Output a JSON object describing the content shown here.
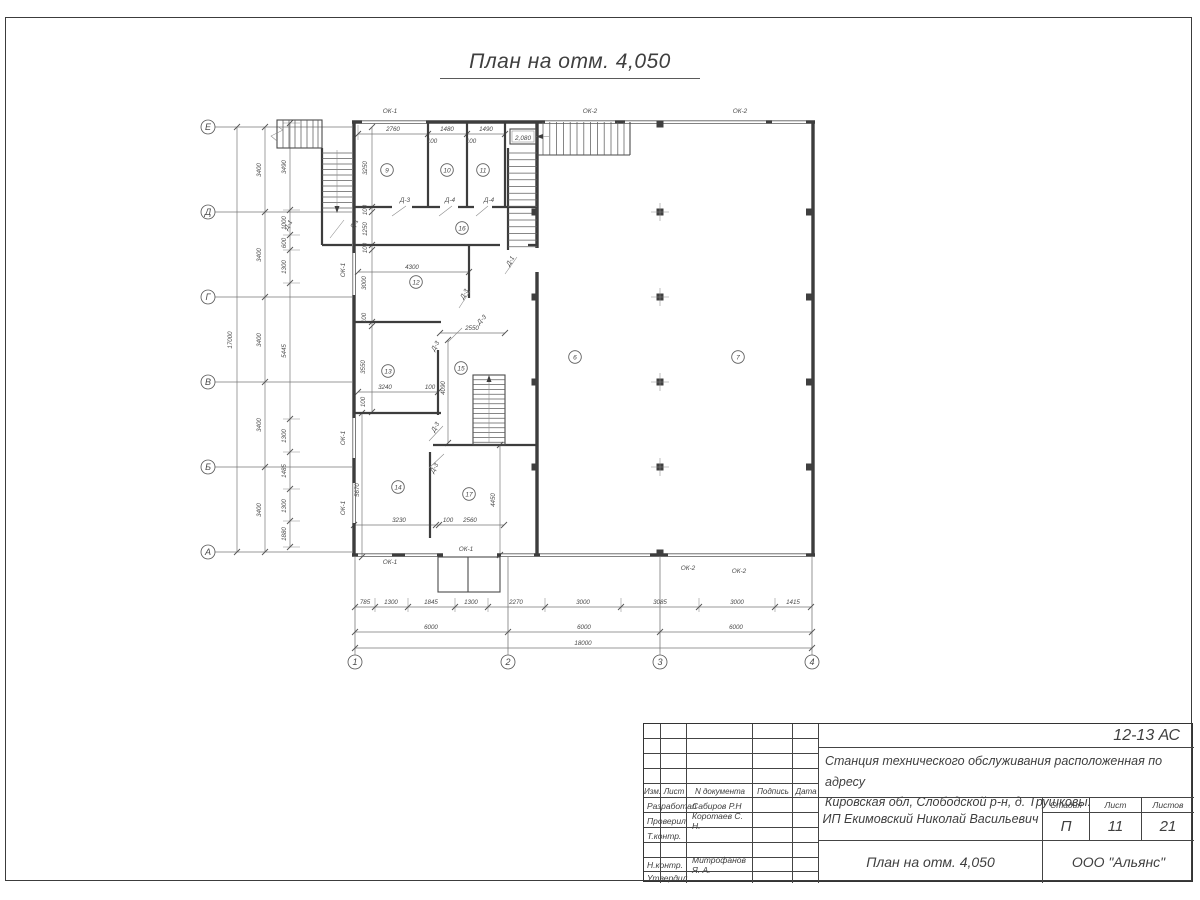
{
  "drawing_title": "План на отм. 4,050",
  "plan": {
    "axis_rows": [
      {
        "label": "Е",
        "y": 127
      },
      {
        "label": "Д",
        "y": 212
      },
      {
        "label": "Г",
        "y": 297
      },
      {
        "label": "В",
        "y": 382
      },
      {
        "label": "Б",
        "y": 467
      },
      {
        "label": "А",
        "y": 552
      }
    ],
    "axis_cols": [
      {
        "label": "1",
        "x": 355
      },
      {
        "label": "2",
        "x": 508
      },
      {
        "label": "3",
        "x": 660
      },
      {
        "label": "4",
        "x": 812
      }
    ],
    "rooms": [
      {
        "t": "9",
        "x": 387,
        "y": 170
      },
      {
        "t": "10",
        "x": 447,
        "y": 170
      },
      {
        "t": "11",
        "x": 483,
        "y": 170
      },
      {
        "t": "16",
        "x": 462,
        "y": 228
      },
      {
        "t": "12",
        "x": 416,
        "y": 282
      },
      {
        "t": "13",
        "x": 388,
        "y": 371
      },
      {
        "t": "15",
        "x": 461,
        "y": 368
      },
      {
        "t": "14",
        "x": 398,
        "y": 487
      },
      {
        "t": "17",
        "x": 469,
        "y": 494
      },
      {
        "t": "6",
        "x": 575,
        "y": 357
      },
      {
        "t": "7",
        "x": 738,
        "y": 357
      }
    ],
    "dims": [
      {
        "t": "17000",
        "x": 232,
        "y": 340,
        "r": -90
      },
      {
        "t": "3400",
        "x": 261,
        "y": 170,
        "r": -90
      },
      {
        "t": "3400",
        "x": 261,
        "y": 255,
        "r": -90
      },
      {
        "t": "3400",
        "x": 261,
        "y": 340,
        "r": -90
      },
      {
        "t": "3400",
        "x": 261,
        "y": 425,
        "r": -90
      },
      {
        "t": "3400",
        "x": 261,
        "y": 510,
        "r": -90
      },
      {
        "t": "3490",
        "x": 286,
        "y": 167,
        "r": -90
      },
      {
        "t": "1000",
        "x": 286,
        "y": 223,
        "r": -90
      },
      {
        "t": "600",
        "x": 286,
        "y": 243,
        "r": -90
      },
      {
        "t": "1300",
        "x": 286,
        "y": 267,
        "r": -90
      },
      {
        "t": "5445",
        "x": 286,
        "y": 351,
        "r": -90
      },
      {
        "t": "1300",
        "x": 286,
        "y": 436,
        "r": -90
      },
      {
        "t": "1485",
        "x": 286,
        "y": 471,
        "r": -90
      },
      {
        "t": "1300",
        "x": 286,
        "y": 506,
        "r": -90
      },
      {
        "t": "1880",
        "x": 286,
        "y": 534,
        "r": -90
      },
      {
        "t": "785",
        "x": 365,
        "y": 604
      },
      {
        "t": "1300",
        "x": 391,
        "y": 604
      },
      {
        "t": "1845",
        "x": 431,
        "y": 604
      },
      {
        "t": "1300",
        "x": 471,
        "y": 604
      },
      {
        "t": "2270",
        "x": 516,
        "y": 604
      },
      {
        "t": "3000",
        "x": 583,
        "y": 604
      },
      {
        "t": "3085",
        "x": 660,
        "y": 604
      },
      {
        "t": "3000",
        "x": 737,
        "y": 604
      },
      {
        "t": "1415",
        "x": 793,
        "y": 604
      },
      {
        "t": "6000",
        "x": 431,
        "y": 629
      },
      {
        "t": "6000",
        "x": 584,
        "y": 629
      },
      {
        "t": "6000",
        "x": 736,
        "y": 629
      },
      {
        "t": "18000",
        "x": 583,
        "y": 645
      },
      {
        "t": "2760",
        "x": 393,
        "y": 131
      },
      {
        "t": "1480",
        "x": 447,
        "y": 131
      },
      {
        "t": "1490",
        "x": 486,
        "y": 131
      },
      {
        "t": "100",
        "x": 432,
        "y": 143
      },
      {
        "t": "100",
        "x": 471,
        "y": 143
      },
      {
        "t": "3250",
        "x": 367,
        "y": 168,
        "r": -90
      },
      {
        "t": "100",
        "x": 367,
        "y": 210,
        "r": -90
      },
      {
        "t": "1250",
        "x": 367,
        "y": 229,
        "r": -90
      },
      {
        "t": "100",
        "x": 367,
        "y": 248,
        "r": -90
      },
      {
        "t": "3000",
        "x": 366,
        "y": 283,
        "r": -90
      },
      {
        "t": "100",
        "x": 366,
        "y": 318,
        "r": -90
      },
      {
        "t": "3550",
        "x": 365,
        "y": 367,
        "r": -90
      },
      {
        "t": "100",
        "x": 365,
        "y": 402,
        "r": -90
      },
      {
        "t": "5670",
        "x": 359,
        "y": 490,
        "r": -90
      },
      {
        "t": "4300",
        "x": 412,
        "y": 269
      },
      {
        "t": "2550",
        "x": 472,
        "y": 330
      },
      {
        "t": "3240",
        "x": 385,
        "y": 389
      },
      {
        "t": "100",
        "x": 430,
        "y": 389
      },
      {
        "t": "4090",
        "x": 445,
        "y": 388,
        "r": -90
      },
      {
        "t": "3230",
        "x": 399,
        "y": 522
      },
      {
        "t": "100",
        "x": 448,
        "y": 522
      },
      {
        "t": "2560",
        "x": 470,
        "y": 522
      },
      {
        "t": "4450",
        "x": 495,
        "y": 500,
        "r": -90
      }
    ],
    "windows": [
      {
        "t": "ОК-1",
        "x": 390,
        "y": 113
      },
      {
        "t": "ОК-2",
        "x": 590,
        "y": 113
      },
      {
        "t": "ОК-2",
        "x": 740,
        "y": 113
      },
      {
        "t": "ОК-1",
        "x": 345,
        "y": 270,
        "r": -90
      },
      {
        "t": "ОК-1",
        "x": 345,
        "y": 438,
        "r": -90
      },
      {
        "t": "ОК-1",
        "x": 345,
        "y": 508,
        "r": -90
      },
      {
        "t": "ОК-1",
        "x": 390,
        "y": 564
      },
      {
        "t": "ОК-1",
        "x": 466,
        "y": 551
      },
      {
        "t": "ОК-2",
        "x": 688,
        "y": 570
      },
      {
        "t": "ОК-2",
        "x": 739,
        "y": 573
      }
    ],
    "doors": [
      {
        "t": "Д-3",
        "x": 405,
        "y": 202
      },
      {
        "t": "Д-4",
        "x": 450,
        "y": 202
      },
      {
        "t": "Д-4",
        "x": 489,
        "y": 202
      },
      {
        "t": "Д-1",
        "x": 290,
        "y": 226,
        "r": -60
      },
      {
        "t": "Д-1",
        "x": 356,
        "y": 225,
        "r": -60
      },
      {
        "t": "Д-1",
        "x": 512,
        "y": 262,
        "r": -60
      },
      {
        "t": "Д-3",
        "x": 466,
        "y": 295,
        "r": -60
      },
      {
        "t": "Д-3",
        "x": 483,
        "y": 321,
        "r": -45
      },
      {
        "t": "Д-3",
        "x": 437,
        "y": 347,
        "r": -60
      },
      {
        "t": "Д-3",
        "x": 437,
        "y": 428,
        "r": -60
      },
      {
        "t": "Д-3",
        "x": 436,
        "y": 469,
        "r": -60
      }
    ],
    "elevation_mark": {
      "t": "2,080",
      "x": 523,
      "y": 140
    }
  },
  "title_block": {
    "code": "12-13 АС",
    "project_line1": "Станция технического обслуживания расположенная по адресу",
    "project_line2": "Кировская обл, Слободской р-н, д. Трушковы.",
    "client": "ИП Екимовский Николай Васильевич",
    "sheet_title": "План на отм. 4,050",
    "company": "ООО \"Альянс\"",
    "stage_label": "Стадия",
    "stage_value": "П",
    "sheet_label": "Лист",
    "sheet_value": "11",
    "sheets_label": "Листов",
    "sheets_value": "21",
    "header_cols": [
      "Изм.",
      "Лист",
      "N документа",
      "Подпись",
      "Дата"
    ],
    "roles": [
      {
        "role": "Разработал",
        "name": "Сабиров Р.Н"
      },
      {
        "role": "Проверил",
        "name": "Коротаев С. Н."
      },
      {
        "role": "Т.контр.",
        "name": ""
      },
      {
        "role": "",
        "name": ""
      },
      {
        "role": "Н.контр.",
        "name": "Митрофанов Я. А."
      },
      {
        "role": "Утвердил",
        "name": ""
      }
    ]
  }
}
